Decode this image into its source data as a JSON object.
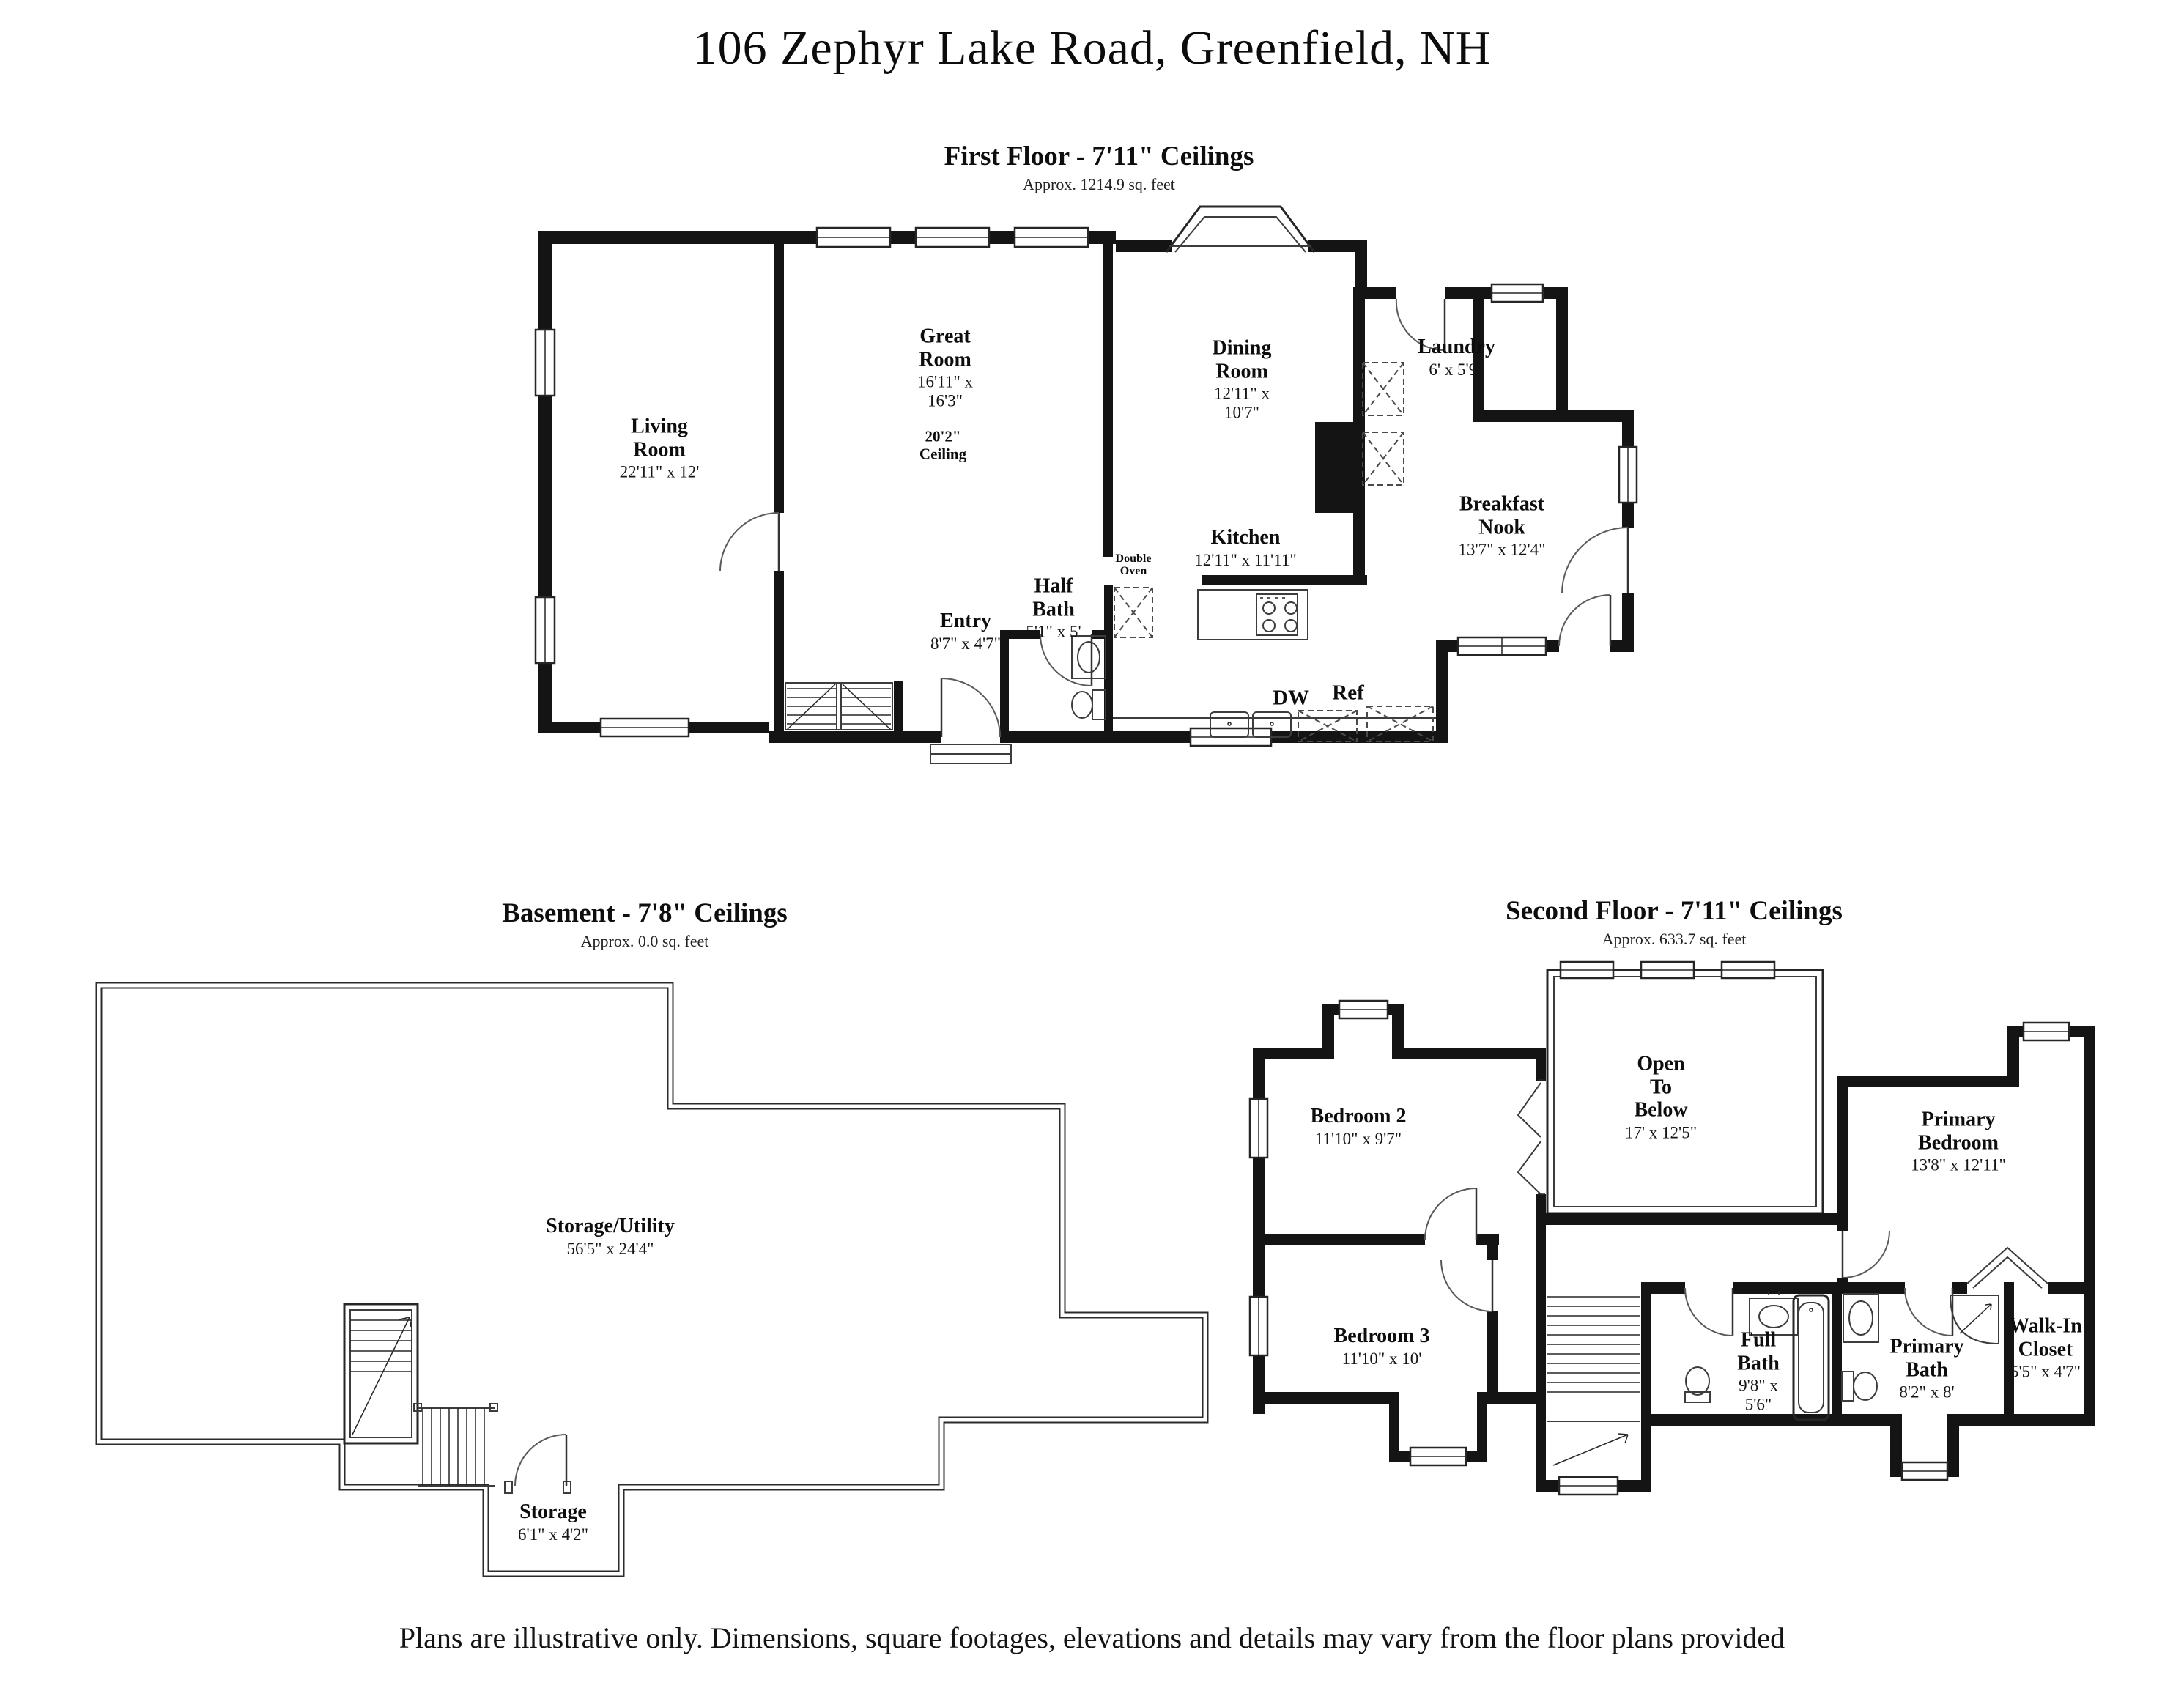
{
  "page": {
    "title": "106 Zephyr Lake Road, Greenfield, NH",
    "disclaimer": "Plans are illustrative only. Dimensions, square footages, elevations and details may vary from the floor plans provided"
  },
  "first_floor": {
    "heading": "First Floor - 7'11\" Ceilings",
    "area_note": "Approx. 1214.9 sq. feet",
    "rooms": {
      "living": {
        "name": "Living Room",
        "dims": "22'11\" x 12'"
      },
      "great": {
        "name": "Great Room",
        "dims": "16'11\" x 16'3\""
      },
      "great_ceiling": {
        "line1": "20'2\"",
        "line2": "Ceiling"
      },
      "dining": {
        "name": "Dining Room",
        "dims": "12'11\" x 10'7\""
      },
      "laundry": {
        "name": "Laundry",
        "dims": "6' x 5'9\""
      },
      "breakfast": {
        "name": "Breakfast Nook",
        "dims": "13'7\" x 12'4\""
      },
      "kitchen": {
        "name": "Kitchen",
        "dims": "12'11\" x 11'11\""
      },
      "half_bath": {
        "name": "Half Bath",
        "dims": "5'1\" x 5'"
      },
      "entry": {
        "name": "Entry",
        "dims": "8'7\" x 4'7\""
      },
      "double_oven": {
        "line1": "Double",
        "line2": "Oven"
      },
      "dw": "DW",
      "ref": "Ref"
    }
  },
  "basement": {
    "heading": "Basement - 7'8\" Ceilings",
    "area_note": "Approx. 0.0 sq. feet",
    "rooms": {
      "storage_utility": {
        "name": "Storage/Utility",
        "dims": "56'5\" x 24'4\""
      },
      "storage": {
        "name": "Storage",
        "dims": "6'1\" x 4'2\""
      }
    }
  },
  "second_floor": {
    "heading": "Second Floor - 7'11\" Ceilings",
    "area_note": "Approx. 633.7 sq. feet",
    "rooms": {
      "bedroom2": {
        "name": "Bedroom 2",
        "dims": "11'10\" x 9'7\""
      },
      "open_below": {
        "name": "Open To Below",
        "dims": "17' x 12'5\""
      },
      "primary_bedroom": {
        "name": "Primary Bedroom",
        "dims": "13'8\" x 12'11\""
      },
      "bedroom3": {
        "name": "Bedroom 3",
        "dims": "11'10\" x 10'"
      },
      "full_bath": {
        "name": "Full Bath",
        "dims": "9'8\" x 5'6\""
      },
      "primary_bath": {
        "name": "Primary Bath",
        "dims": "8'2\" x 8'"
      },
      "walk_in": {
        "name": "Walk-In Closet",
        "dims": "5'5\" x 4'7\""
      }
    }
  }
}
